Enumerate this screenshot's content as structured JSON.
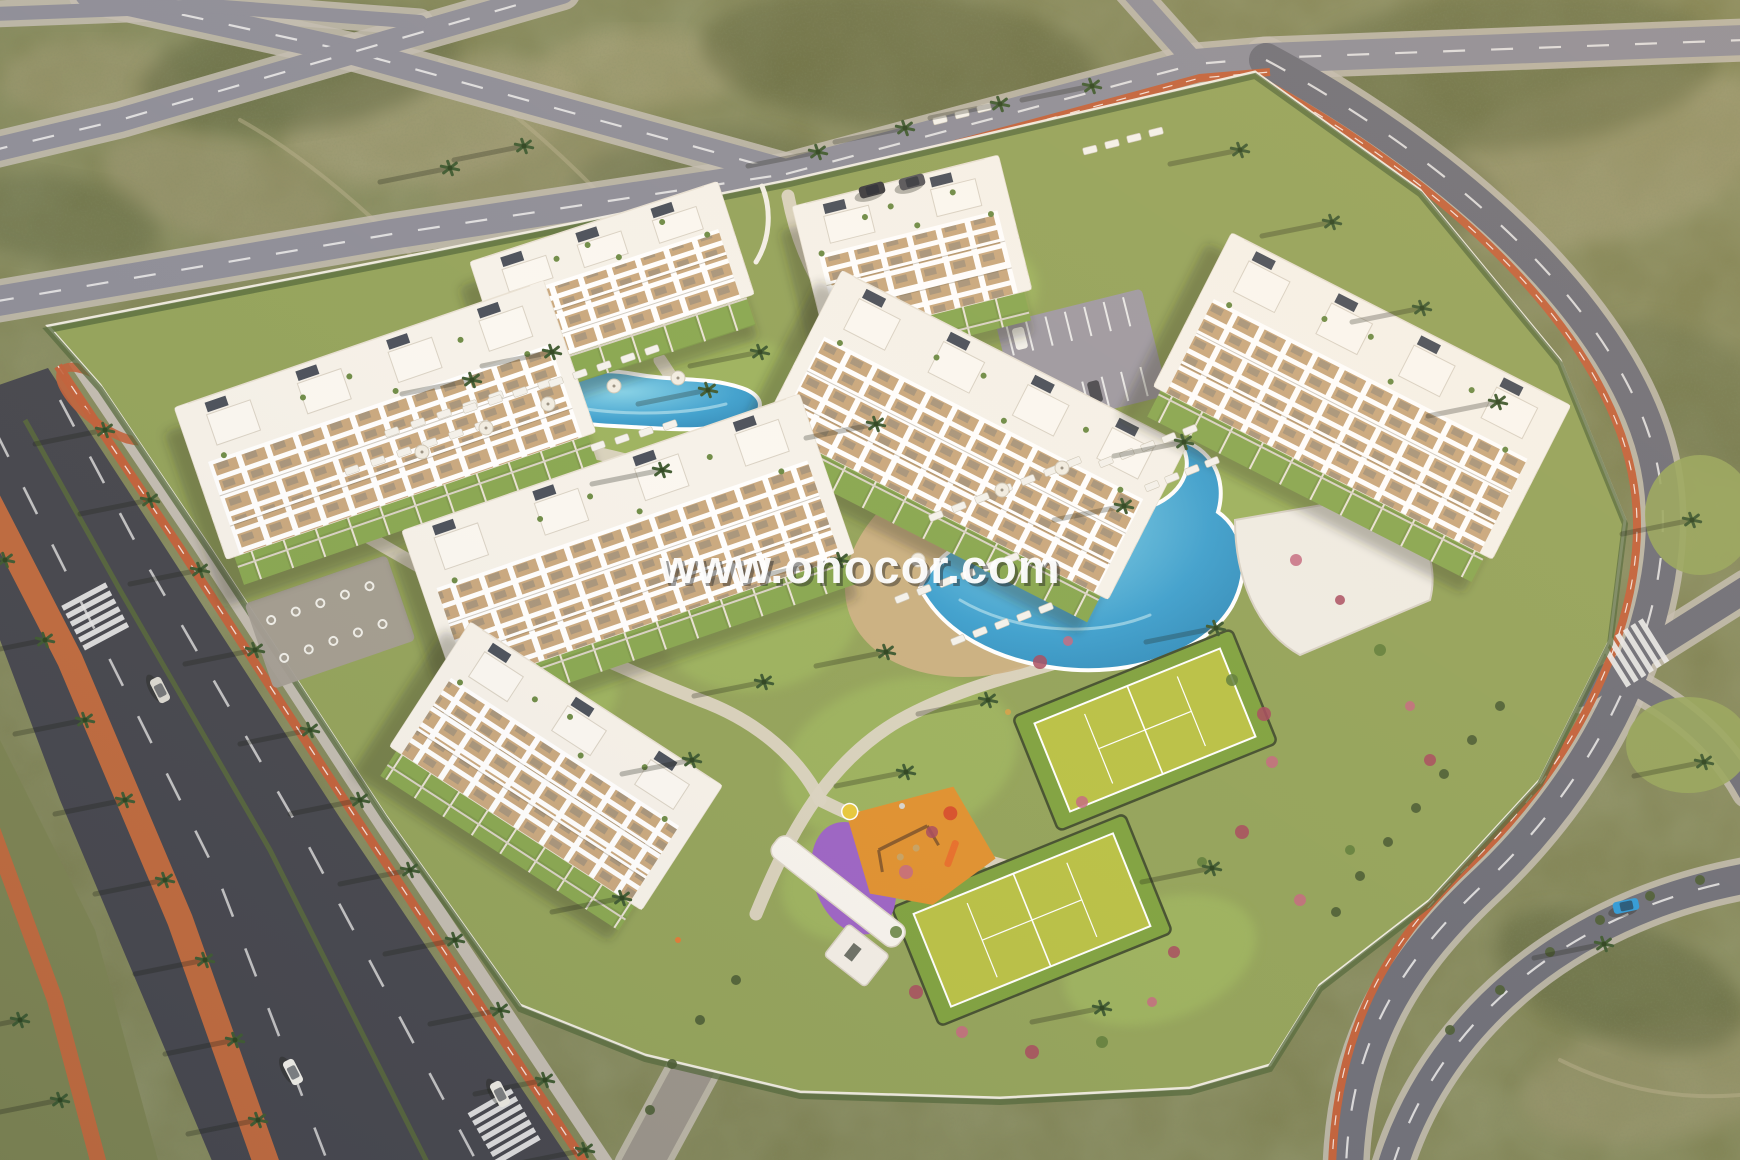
{
  "watermark": {
    "text": "www.onocor.com"
  },
  "palette": {
    "scrub_base": "#7d8152",
    "scrub_dark": "#5b6540",
    "scrub_light": "#a6a27b",
    "asphalt_light": "#8d8d98",
    "asphalt_mid": "#6d6e78",
    "asphalt_dark": "#45464d",
    "lane_white": "#ececec",
    "bike_orange": "#c2613a",
    "sidewalk": "#c2bcb1",
    "lot_green": "#93a35a",
    "lawn": "#9db45f",
    "path_cream": "#dbd4c2",
    "pool_blue": "#3da0cf",
    "pool_deep": "#2a80af",
    "pool_light": "#85d2e8",
    "beach_sand": "#ccb184",
    "building_white": "#f6f2ea",
    "balcony_tan": "#c9a87e",
    "solar": "#39414d",
    "court_green": "#b9c145",
    "court_rim": "#7fa23f",
    "play_orange": "#e0912f",
    "play_purple": "#9c63c5",
    "hedge": "#53683b",
    "palm_green": "#3e5a31",
    "palm_dark": "#2c431f",
    "flower_colors": [
      "#a84a5e",
      "#c46a80",
      "#5e7c3a"
    ],
    "wall_white": "#f2efe6",
    "shadow": "rgba(40,46,28,0.30)"
  },
  "terrain": {
    "patches": [
      [
        430,
        120,
        150,
        60,
        -10,
        "#aca581",
        0.5
      ],
      [
        220,
        190,
        120,
        50,
        15,
        "#a19a76",
        0.45
      ],
      [
        640,
        70,
        100,
        40,
        0,
        "#b0a87f",
        0.4
      ],
      [
        1240,
        330,
        160,
        70,
        20,
        "#9a976f",
        0.4
      ],
      [
        1600,
        160,
        180,
        80,
        -15,
        "#a5a07a",
        0.45
      ],
      [
        90,
        80,
        90,
        40,
        0,
        "#a8a07a",
        0.4
      ],
      [
        1660,
        1080,
        140,
        60,
        -10,
        "#9c9871",
        0.5
      ],
      [
        540,
        170,
        110,
        45,
        -12,
        "#9f9873",
        0.4
      ],
      [
        900,
        60,
        200,
        70,
        5,
        "#5a6138",
        0.5
      ],
      [
        300,
        70,
        160,
        60,
        -8,
        "#59613a",
        0.5
      ],
      [
        1500,
        70,
        220,
        80,
        -5,
        "#566037",
        0.45
      ],
      [
        60,
        220,
        100,
        45,
        10,
        "#5b6540",
        0.4
      ],
      [
        1700,
        400,
        120,
        60,
        30,
        "#5d6741",
        0.4
      ],
      [
        1350,
        180,
        150,
        60,
        10,
        "#57603a",
        0.4
      ],
      [
        700,
        180,
        130,
        50,
        -5,
        "#5a6440",
        0.35
      ],
      [
        1620,
        980,
        130,
        60,
        20,
        "#525c36",
        0.45
      ]
    ],
    "trails": [
      "M 440,60 C 530,120 600,190 660,260",
      "M 240,120 C 330,170 420,260 480,330",
      "M 1080,110 C 1140,200 1175,290 1185,360",
      "M 1300,140 C 1360,180 1420,240 1460,300",
      "M 1560,1060 C 1620,1090 1680,1100 1740,1095"
    ]
  },
  "roads": [
    {
      "name": "road-top-a",
      "d": "M 88,-6 L 353,52 L 562,110 L 786,172",
      "w": 26,
      "c": "#8d8d98",
      "dash": true
    },
    {
      "name": "road-top-b",
      "d": "M 562,-8 L 353,52 L 120,120 L -6,150",
      "w": 24,
      "c": "#8d8d98",
      "dash": true
    },
    {
      "name": "road-top-edge",
      "d": "M -6,14 L 210,6 L 420,22",
      "w": 14,
      "c": "#8d8d98",
      "dash": false
    },
    {
      "name": "boulevard-west",
      "d": "M -8,302 L 392,234 L 786,174",
      "w": 30,
      "c": "#8d8d98",
      "dash": true
    },
    {
      "name": "boulevard-northeast",
      "d": "M 786,174 L 1196,64 L 1266,58 L 1745,40",
      "w": 30,
      "c": "#8d8d98",
      "dash": true
    },
    {
      "name": "road-north-stub",
      "d": "M 1196,64 L 1130,-10",
      "w": 20,
      "c": "#8d8d98",
      "dash": false
    },
    {
      "name": "road-east",
      "d": "M 1266,60 C 1470,170 1638,330 1660,480 C 1678,600 1612,762 1488,880 C 1402,960 1350,1040 1346,1168",
      "w": 34,
      "c": "#6d6e78",
      "dash": true
    },
    {
      "name": "road-branch-east",
      "d": "M 1580,694 L 1748,588",
      "w": 26,
      "c": "#6d6e78",
      "dash": false
    },
    {
      "name": "road-fork-east",
      "d": "M 1640,688 C 1700,722 1728,756 1748,792",
      "w": 20,
      "c": "#6d6e78",
      "dash": false
    },
    {
      "name": "road-loop-southeast",
      "d": "M 1392,1168 C 1434,1030 1560,912 1748,878",
      "w": 30,
      "c": "#6d6e78",
      "dash": true
    },
    {
      "name": "entrance-drive",
      "d": "M 640,1168 L 720,1020 L 756,914",
      "w": 40,
      "c": "#9a948a",
      "dash": false
    }
  ],
  "highway": {
    "asphalt": [
      [
        -30,
        395
      ],
      [
        48,
        368
      ],
      [
        168,
        552
      ],
      [
        340,
        818
      ],
      [
        575,
        1168
      ],
      [
        215,
        1168
      ],
      [
        60,
        800
      ],
      [
        -30,
        560
      ]
    ],
    "hedge_median": "M 25,420 L 120,590 L 270,850 L 430,1168",
    "dashes": [
      "M -5,430 L 85,610 L 215,870 L 330,1168",
      "M 60,400 L 150,570 L 300,830 L 480,1168"
    ],
    "bike": "M 58,366 L 180,548 L 352,812 L 588,1168",
    "sidewalk": "M 74,360 L 198,544 L 370,808 L 610,1168",
    "orange_median": "M -20,485 L 70,660 L 180,920 L 268,1168",
    "corner_verge": [
      [
        -20,
        700
      ],
      [
        95,
        930
      ],
      [
        160,
        1168
      ],
      [
        -20,
        1168
      ]
    ],
    "corner_path": "M -15,810 L 55,1000 L 100,1168",
    "slip_ellipse": [
      105,
      404,
      54,
      20,
      38
    ]
  },
  "bike_lanes": [
    {
      "d": "M 792,188 L 1200,78 L 1270,72",
      "w": 8
    },
    {
      "d": "M 1252,76 C 1448,182 1612,336 1634,486 C 1652,602 1588,752 1466,868 C 1386,944 1336,1030 1332,1168",
      "w": 8
    }
  ],
  "crosswalks": [
    [
      505,
      1128,
      60,
      7
    ],
    [
      1636,
      652,
      -32,
      6
    ],
    [
      96,
      618,
      62,
      6
    ]
  ],
  "lot": {
    "outline": [
      [
        790,
        180
      ],
      [
        1255,
        72
      ],
      [
        1420,
        190
      ],
      [
        1560,
        360
      ],
      [
        1625,
        520
      ],
      [
        1610,
        640
      ],
      [
        1540,
        780
      ],
      [
        1430,
        900
      ],
      [
        1320,
        985
      ],
      [
        1270,
        1065
      ],
      [
        1190,
        1088
      ],
      [
        1000,
        1098
      ],
      [
        800,
        1092
      ],
      [
        645,
        1055
      ],
      [
        520,
        1005
      ],
      [
        385,
        815
      ],
      [
        210,
        548
      ],
      [
        100,
        385
      ],
      [
        48,
        326
      ],
      [
        430,
        252
      ]
    ]
  },
  "lawns": [
    [
      700,
      430,
      130,
      90,
      -15
    ],
    [
      760,
      620,
      100,
      70,
      -10
    ],
    [
      950,
      300,
      90,
      60,
      -15
    ],
    [
      1240,
      470,
      120,
      70,
      25
    ],
    [
      580,
      330,
      110,
      60,
      -18
    ],
    [
      900,
      760,
      120,
      80,
      -15
    ],
    [
      1160,
      960,
      100,
      60,
      -20
    ],
    [
      530,
      700,
      90,
      60,
      -15
    ],
    [
      1060,
      600,
      90,
      60,
      -15
    ],
    [
      860,
      880,
      80,
      60,
      -15
    ]
  ],
  "east_lawns": [
    [
      1700,
      515,
      55,
      60
    ],
    [
      1688,
      745,
      62,
      48
    ]
  ],
  "paths": [
    "M 788,196 C 800,260 830,310 870,350",
    "M 756,914 C 790,830 830,760 900,720 C 980,676 1060,668 1120,640",
    "M 340,520 C 470,600 600,660 700,700 C 760,722 800,760 820,800",
    "M 660,360 C 700,420 730,470 740,520",
    "M 1120,640 C 1190,610 1240,570 1290,540",
    "M 820,800 C 900,840 980,860 1060,880",
    "M 440,420 C 520,440 600,450 660,470"
  ],
  "beach": [
    1000,
    560,
    160,
    110,
    -20
  ],
  "pools": [
    {
      "name": "main-lagoon-pool",
      "d": "M 920,588 C 938,548 986,524 1040,516 C 1086,510 1118,520 1152,506 C 1186,492 1196,462 1178,440 C 1210,446 1228,478 1218,512 C 1244,530 1252,570 1232,606 C 1204,654 1128,678 1056,668 C 996,660 944,634 920,588 Z",
      "hl": "M 960,600 C 1010,630 1090,640 1150,615"
    },
    {
      "name": "north-pool",
      "d": "M 528,400 C 552,376 592,366 634,374 C 678,382 706,376 742,388 C 766,396 766,414 742,422 C 700,434 658,428 614,426 C 570,424 542,416 528,400 Z",
      "hl": "M 560,404 C 610,416 680,416 726,404"
    }
  ],
  "pool_house": {
    "d": "M 1235,520 L 1380,495 C 1420,520 1440,560 1430,600 L 1300,655 C 1255,630 1235,575 1235,520 Z"
  },
  "courts": [
    [
      1145,
      730,
      200,
      95,
      -22
    ],
    [
      1032,
      920,
      215,
      100,
      -22
    ]
  ],
  "playgrounds": {
    "south": {
      "x": 902,
      "y": 850,
      "rot": -20
    },
    "west": {
      "x": 470,
      "y": 512,
      "rot": -20
    }
  },
  "parking": {
    "x": 1082,
    "y": 360,
    "rot": -14,
    "w": 150,
    "h": 110
  },
  "bike_park": {
    "x": 330,
    "y": 622,
    "rot": -19,
    "w": 150,
    "h": 90
  },
  "gate": {
    "x": 808,
    "y": 930,
    "rot": 38
  },
  "north_gate_arcs": [
    "M 762,186 C 772,210 770,240 756,262",
    "M 820,206 C 812,232 814,256 826,278"
  ],
  "buildings": [
    [
      612,
      278,
      260,
      118,
      -18
    ],
    [
      385,
      420,
      390,
      160,
      -19
    ],
    [
      912,
      248,
      212,
      138,
      -14
    ],
    [
      975,
      435,
      386,
      172,
      27
    ],
    [
      1362,
      396,
      380,
      172,
      27
    ],
    [
      628,
      542,
      420,
      168,
      -19
    ],
    [
      556,
      766,
      300,
      148,
      33
    ]
  ],
  "lounger_rows": [
    [
      352,
      470,
      26,
      -9,
      6,
      -19
    ],
    [
      392,
      432,
      26,
      -9,
      5,
      -19
    ],
    [
      470,
      408,
      25,
      -8,
      4,
      -19
    ],
    [
      556,
      382,
      24,
      -8,
      5,
      -19
    ],
    [
      598,
      446,
      24,
      -7,
      4,
      -19
    ],
    [
      936,
      516,
      23,
      -9,
      7,
      -22
    ],
    [
      902,
      598,
      22,
      -8,
      6,
      -22
    ],
    [
      958,
      640,
      22,
      -8,
      5,
      -22
    ],
    [
      1106,
      462,
      21,
      -8,
      5,
      -22
    ],
    [
      1152,
      486,
      20,
      -8,
      4,
      -22
    ],
    [
      1090,
      150,
      22,
      -6,
      4,
      -14
    ],
    [
      940,
      120,
      22,
      -6,
      3,
      -14
    ]
  ],
  "umbrellas": [
    [
      422,
      452
    ],
    [
      486,
      428
    ],
    [
      548,
      404
    ],
    [
      614,
      386
    ],
    [
      678,
      378
    ],
    [
      1002,
      490
    ],
    [
      1062,
      468
    ],
    [
      918,
      560
    ]
  ],
  "palms": [
    [
      105,
      430
    ],
    [
      150,
      500
    ],
    [
      200,
      570
    ],
    [
      255,
      650
    ],
    [
      310,
      730
    ],
    [
      360,
      800
    ],
    [
      410,
      870
    ],
    [
      455,
      940
    ],
    [
      500,
      1010
    ],
    [
      545,
      1080
    ],
    [
      585,
      1150
    ],
    [
      5,
      560
    ],
    [
      45,
      640
    ],
    [
      85,
      720
    ],
    [
      125,
      800
    ],
    [
      165,
      880
    ],
    [
      205,
      960
    ],
    [
      235,
      1040
    ],
    [
      258,
      1120
    ],
    [
      20,
      1020
    ],
    [
      60,
      1100
    ],
    [
      905,
      128
    ],
    [
      1000,
      104
    ],
    [
      1092,
      86
    ],
    [
      818,
      152
    ],
    [
      1240,
      150
    ],
    [
      1332,
      222
    ],
    [
      1422,
      308
    ],
    [
      1498,
      402
    ],
    [
      450,
      168
    ],
    [
      524,
      146
    ],
    [
      760,
      352
    ],
    [
      708,
      390
    ],
    [
      876,
      424
    ],
    [
      1184,
      442
    ],
    [
      1216,
      628
    ],
    [
      886,
      652
    ],
    [
      764,
      682
    ],
    [
      988,
      700
    ],
    [
      1124,
      506
    ],
    [
      662,
      470
    ],
    [
      552,
      352
    ],
    [
      472,
      380
    ],
    [
      840,
      560
    ],
    [
      692,
      760
    ],
    [
      906,
      772
    ],
    [
      1212,
      868
    ],
    [
      1102,
      1008
    ],
    [
      622,
      898
    ],
    [
      1692,
      520
    ],
    [
      1704,
      762
    ],
    [
      1604,
      944
    ]
  ],
  "cars": [
    [
      293,
      1072,
      63,
      "#f0efe9"
    ],
    [
      500,
      1094,
      63,
      "#eceae2"
    ],
    [
      160,
      690,
      63,
      "#dddbd2"
    ],
    [
      872,
      190,
      -15,
      "#3a3a3e"
    ],
    [
      912,
      182,
      -15,
      "#55555a"
    ],
    [
      1626,
      906,
      -12,
      "#2e9ad8"
    ]
  ],
  "people": [
    [
      678,
      940,
      "#e07b35"
    ],
    [
      902,
      806,
      "#d8d5ce"
    ],
    [
      1008,
      712,
      "#cfa24a"
    ]
  ],
  "flowers": [
    [
      1040,
      662,
      7,
      0
    ],
    [
      1068,
      641,
      5,
      1
    ],
    [
      1232,
      680,
      6,
      2
    ],
    [
      1264,
      714,
      7,
      0
    ],
    [
      1272,
      762,
      6,
      1
    ],
    [
      1242,
      832,
      7,
      0
    ],
    [
      1202,
      862,
      5,
      2
    ],
    [
      1082,
      802,
      6,
      1
    ],
    [
      932,
      832,
      6,
      0
    ],
    [
      906,
      872,
      7,
      1
    ],
    [
      896,
      932,
      6,
      2
    ],
    [
      916,
      992,
      7,
      0
    ],
    [
      962,
      1032,
      6,
      1
    ],
    [
      1032,
      1052,
      7,
      0
    ],
    [
      1102,
      1042,
      6,
      2
    ],
    [
      1152,
      1002,
      5,
      1
    ],
    [
      1174,
      952,
      6,
      0
    ],
    [
      1296,
      560,
      6,
      1
    ],
    [
      1340,
      600,
      5,
      0
    ],
    [
      1380,
      650,
      6,
      2
    ],
    [
      1410,
      706,
      5,
      1
    ],
    [
      1430,
      760,
      6,
      0
    ],
    [
      1300,
      900,
      6,
      1
    ],
    [
      1350,
      850,
      5,
      2
    ],
    [
      452,
      470,
      6,
      0
    ],
    [
      430,
      540,
      5,
      1
    ],
    [
      508,
      480,
      5,
      2
    ]
  ],
  "hedge_dots": [
    [
      1500,
      706
    ],
    [
      1472,
      740
    ],
    [
      1444,
      774
    ],
    [
      1416,
      808
    ],
    [
      1388,
      842
    ],
    [
      1360,
      876
    ],
    [
      1336,
      912
    ],
    [
      1450,
      1030
    ],
    [
      1500,
      990
    ],
    [
      1550,
      952
    ],
    [
      1600,
      920
    ],
    [
      1650,
      896
    ],
    [
      1700,
      880
    ],
    [
      700,
      1020
    ],
    [
      672,
      1064
    ],
    [
      650,
      1110
    ],
    [
      736,
      980
    ]
  ]
}
